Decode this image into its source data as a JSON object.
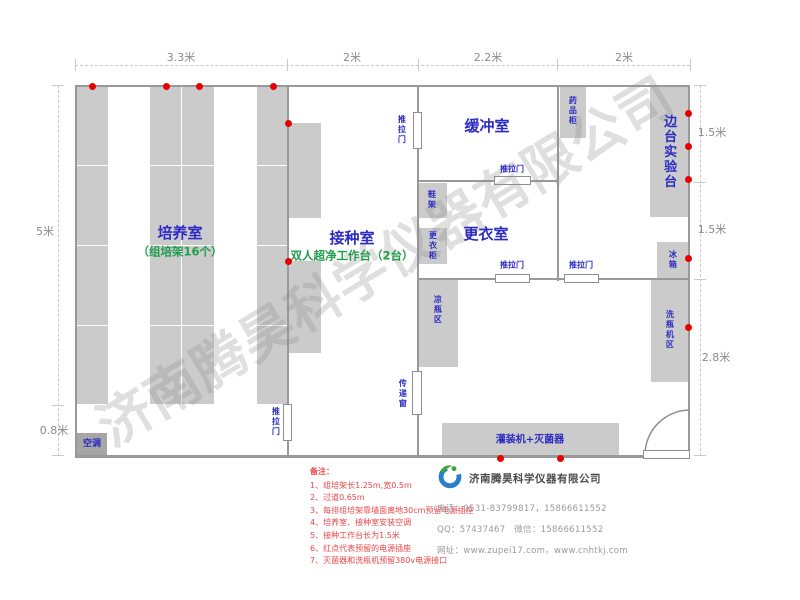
{
  "watermark": "济南腾昊科学仪器有限公司",
  "colors": {
    "blue": "#2b2bc4",
    "green": "#1f9e4d",
    "dim_grey": "#8a8a8a",
    "dot_red": "#e60000",
    "note_red": "#e8474a",
    "wall_grey": "#999999",
    "furniture_grey": "#cbcbcb"
  },
  "walls": [
    {
      "name": "outer-wall-top",
      "r": [
        75,
        85,
        615,
        2
      ]
    },
    {
      "name": "outer-wall-bottom",
      "r": [
        75,
        455,
        615,
        3
      ]
    },
    {
      "name": "outer-wall-left",
      "r": [
        75,
        85,
        2,
        373
      ]
    },
    {
      "name": "outer-wall-right",
      "r": [
        688,
        85,
        2,
        373
      ]
    },
    {
      "name": "wall-culture-inoculation-upper",
      "r": [
        287,
        85,
        2,
        320
      ]
    },
    {
      "name": "wall-culture-inoculation-lower",
      "r": [
        287,
        441,
        2,
        16
      ]
    },
    {
      "name": "wall-inoculation-buffer-upper",
      "r": [
        417,
        85,
        2,
        28
      ]
    },
    {
      "name": "wall-inoculation-buffer-lower",
      "r": [
        417,
        148,
        2,
        309
      ]
    },
    {
      "name": "wall-buffer-sidebench",
      "r": [
        557,
        85,
        2,
        196
      ]
    },
    {
      "name": "wall-buffer-changing-left",
      "r": [
        418,
        180,
        77,
        2
      ]
    },
    {
      "name": "wall-buffer-changing-right",
      "r": [
        530,
        180,
        28,
        2
      ]
    },
    {
      "name": "wall-changing-bottomroom-1",
      "r": [
        418,
        278,
        78,
        2
      ]
    },
    {
      "name": "wall-changing-bottomroom-2",
      "r": [
        529,
        278,
        36,
        2
      ]
    },
    {
      "name": "wall-changing-bottomroom-3",
      "r": [
        598,
        278,
        92,
        2
      ]
    }
  ],
  "furniture": [
    {
      "name": "culture-rack-1",
      "r": [
        77,
        86,
        31,
        318
      ]
    },
    {
      "name": "culture-rack-2",
      "r": [
        150,
        86,
        64,
        318
      ]
    },
    {
      "name": "culture-rack-3",
      "r": [
        257,
        86,
        30,
        318
      ]
    },
    {
      "name": "clean-bench-1",
      "r": [
        289,
        123,
        32,
        95
      ]
    },
    {
      "name": "clean-bench-2",
      "r": [
        289,
        261,
        32,
        92
      ]
    },
    {
      "name": "medicine-cabinet",
      "r": [
        560,
        86,
        26,
        52
      ]
    },
    {
      "name": "side-lab-bench",
      "r": [
        650,
        86,
        39,
        131
      ]
    },
    {
      "name": "fridge",
      "r": [
        657,
        242,
        32,
        36
      ]
    },
    {
      "name": "bottle-washer-area",
      "r": [
        651,
        280,
        38,
        102
      ]
    },
    {
      "name": "bottle-cooling-area",
      "r": [
        419,
        280,
        39,
        87
      ]
    },
    {
      "name": "shoe-rack",
      "r": [
        419,
        183,
        28,
        35
      ]
    },
    {
      "name": "wardrobe",
      "r": [
        419,
        228,
        28,
        36
      ]
    },
    {
      "name": "filling-sterilizer-bench",
      "r": [
        442,
        423,
        177,
        34
      ]
    },
    {
      "name": "air-conditioner",
      "r": [
        77,
        433,
        30,
        23
      ],
      "dark": true
    }
  ],
  "dividers": [
    {
      "r": [
        77,
        165,
        31,
        1
      ]
    },
    {
      "r": [
        77,
        245,
        31,
        1
      ]
    },
    {
      "r": [
        77,
        325,
        31,
        1
      ]
    },
    {
      "r": [
        150,
        165,
        64,
        1
      ]
    },
    {
      "r": [
        150,
        245,
        64,
        1
      ]
    },
    {
      "r": [
        150,
        325,
        64,
        1
      ]
    },
    {
      "r": [
        257,
        165,
        30,
        1
      ]
    },
    {
      "r": [
        257,
        245,
        30,
        1
      ]
    },
    {
      "r": [
        257,
        325,
        30,
        1
      ]
    },
    {
      "r": [
        181,
        86,
        1,
        318
      ]
    }
  ],
  "doors": [
    {
      "name": "sliding-door-culture-room",
      "r": [
        283,
        404,
        9,
        37
      ]
    },
    {
      "name": "sliding-door-inoculation-room",
      "r": [
        413,
        112,
        9,
        37
      ]
    },
    {
      "name": "transfer-window",
      "r": [
        412,
        371,
        10,
        44
      ]
    },
    {
      "name": "sliding-door-buffer-changing",
      "r": [
        494,
        176,
        37,
        9
      ]
    },
    {
      "name": "sliding-door-changing-bottom",
      "r": [
        495,
        274,
        35,
        9
      ]
    },
    {
      "name": "sliding-door-sidebench-bottom",
      "r": [
        564,
        274,
        35,
        9
      ]
    },
    {
      "name": "entrance-door-leaf",
      "r": [
        643,
        450,
        47,
        9
      ]
    }
  ],
  "entrance_arc": {
    "cx": 690,
    "cy": 455,
    "r": 45
  },
  "dots": [
    {
      "x": 92,
      "y": 86
    },
    {
      "x": 166,
      "y": 86
    },
    {
      "x": 199,
      "y": 86
    },
    {
      "x": 273,
      "y": 86
    },
    {
      "x": 288,
      "y": 123
    },
    {
      "x": 288,
      "y": 261
    },
    {
      "x": 500,
      "y": 458
    },
    {
      "x": 560,
      "y": 458
    },
    {
      "x": 688,
      "y": 113
    },
    {
      "x": 688,
      "y": 146
    },
    {
      "x": 688,
      "y": 179
    },
    {
      "x": 688,
      "y": 258
    },
    {
      "x": 688,
      "y": 327
    }
  ],
  "labels": [
    {
      "name": "culture-room-label",
      "t": "培养室",
      "x": 180,
      "y": 233,
      "s": 15,
      "b": 1,
      "c": "blue"
    },
    {
      "name": "culture-room-sublabel",
      "t": "（组培架16个）",
      "x": 180,
      "y": 252,
      "s": 11.5,
      "b": 1,
      "c": "green"
    },
    {
      "name": "inoculation-room-label",
      "t": "接种室",
      "x": 352,
      "y": 238,
      "s": 15,
      "b": 1,
      "c": "blue"
    },
    {
      "name": "inoculation-room-sublabel",
      "t": "双人超净工作台（2台）",
      "x": 352,
      "y": 256,
      "s": 11.5,
      "b": 1,
      "c": "green"
    },
    {
      "name": "buffer-room-label",
      "t": "缓冲室",
      "x": 487,
      "y": 126,
      "s": 15,
      "b": 1,
      "c": "blue"
    },
    {
      "name": "changing-room-label",
      "t": "更衣室",
      "x": 486,
      "y": 234,
      "s": 15,
      "b": 1,
      "c": "blue"
    },
    {
      "name": "side-lab-bench-label",
      "t": "边台实验台",
      "x": 668,
      "y": 152,
      "s": 13,
      "b": 1,
      "c": "blue",
      "v": 1
    },
    {
      "name": "medicine-cabinet-label",
      "t": "药品柜",
      "x": 572,
      "y": 111,
      "s": 8,
      "b": 1,
      "c": "blue",
      "v": 1
    },
    {
      "name": "shoe-rack-label",
      "t": "鞋架",
      "x": 431,
      "y": 200,
      "s": 8,
      "b": 1,
      "c": "blue",
      "v": 1
    },
    {
      "name": "wardrobe-label",
      "t": "更衣柜",
      "x": 432,
      "y": 246,
      "s": 8,
      "b": 1,
      "c": "blue",
      "v": 1
    },
    {
      "name": "bottle-cooling-label",
      "t": "凉瓶区",
      "x": 437,
      "y": 310,
      "s": 8,
      "b": 1,
      "c": "blue",
      "v": 1
    },
    {
      "name": "fridge-label",
      "t": "冰箱",
      "x": 672,
      "y": 260,
      "s": 8,
      "b": 1,
      "c": "blue",
      "v": 1
    },
    {
      "name": "bottle-washer-label",
      "t": "洗瓶机区",
      "x": 669,
      "y": 330,
      "s": 8,
      "b": 1,
      "c": "blue",
      "v": 1
    },
    {
      "name": "transfer-window-label",
      "t": "传递窗",
      "x": 402,
      "y": 394,
      "s": 8,
      "b": 1,
      "c": "blue",
      "v": 1
    },
    {
      "name": "sliding-door-label-1",
      "t": "推拉门",
      "x": 401,
      "y": 130,
      "s": 8,
      "b": 1,
      "c": "blue",
      "v": 1
    },
    {
      "name": "sliding-door-label-2",
      "t": "推拉门",
      "x": 275,
      "y": 422,
      "s": 8,
      "b": 1,
      "c": "blue",
      "v": 1
    },
    {
      "name": "sliding-door-label-3",
      "t": "推拉门",
      "x": 512,
      "y": 170,
      "s": 8,
      "b": 1,
      "c": "blue"
    },
    {
      "name": "sliding-door-label-4",
      "t": "推拉门",
      "x": 512,
      "y": 266,
      "s": 8,
      "b": 1,
      "c": "blue"
    },
    {
      "name": "sliding-door-label-5",
      "t": "推拉门",
      "x": 581,
      "y": 266,
      "s": 8,
      "b": 1,
      "c": "blue"
    },
    {
      "name": "filling-sterilizer-label",
      "t": "灌装机+灭菌器",
      "x": 530,
      "y": 440,
      "s": 10,
      "b": 1,
      "c": "blue"
    },
    {
      "name": "air-conditioner-label",
      "t": "空调",
      "x": 92,
      "y": 445,
      "s": 9,
      "b": 1,
      "c": "blue"
    },
    {
      "name": "dim-top-1",
      "t": "3.3米",
      "x": 181,
      "y": 58,
      "s": 11,
      "c": "grey"
    },
    {
      "name": "dim-top-2",
      "t": "2米",
      "x": 352,
      "y": 58,
      "s": 11,
      "c": "grey"
    },
    {
      "name": "dim-top-3",
      "t": "2.2米",
      "x": 488,
      "y": 58,
      "s": 11,
      "c": "grey"
    },
    {
      "name": "dim-top-4",
      "t": "2米",
      "x": 624,
      "y": 58,
      "s": 11,
      "c": "grey"
    },
    {
      "name": "dim-left-1",
      "t": "5米",
      "x": 45,
      "y": 232,
      "s": 11,
      "c": "grey"
    },
    {
      "name": "dim-left-2",
      "t": "0.8米",
      "x": 54,
      "y": 431,
      "s": 11,
      "c": "grey"
    },
    {
      "name": "dim-right-1",
      "t": "1.5米",
      "x": 712,
      "y": 133,
      "s": 11,
      "c": "grey"
    },
    {
      "name": "dim-right-2",
      "t": "1.5米",
      "x": 712,
      "y": 230,
      "s": 11,
      "c": "grey"
    },
    {
      "name": "dim-right-3",
      "t": "2.8米",
      "x": 716,
      "y": 358,
      "s": 11,
      "c": "grey"
    }
  ],
  "dim_lines": [
    {
      "name": "dim-line-top",
      "kind": "h",
      "x": 75,
      "y": 65,
      "len": 615
    },
    {
      "name": "dim-line-left",
      "kind": "v",
      "x": 58,
      "y": 85,
      "len": 371
    },
    {
      "name": "dim-line-right",
      "kind": "v",
      "x": 700,
      "y": 85,
      "len": 371
    }
  ],
  "ticks": [
    {
      "r": [
        75,
        59,
        1,
        12
      ]
    },
    {
      "r": [
        287,
        59,
        1,
        12
      ]
    },
    {
      "r": [
        418,
        59,
        1,
        12
      ]
    },
    {
      "r": [
        557,
        59,
        1,
        12
      ]
    },
    {
      "r": [
        690,
        59,
        1,
        12
      ]
    },
    {
      "r": [
        52,
        85,
        12,
        1
      ]
    },
    {
      "r": [
        52,
        405,
        12,
        1
      ]
    },
    {
      "r": [
        52,
        455,
        12,
        1
      ]
    },
    {
      "r": [
        694,
        85,
        12,
        1
      ]
    },
    {
      "r": [
        694,
        182,
        12,
        1
      ]
    },
    {
      "r": [
        694,
        279,
        12,
        1
      ]
    },
    {
      "r": [
        694,
        455,
        12,
        1
      ]
    }
  ],
  "notes": {
    "title": "备注：",
    "items": [
      "1、组培架长1.25m,宽0.5m",
      "2、过道0.65m",
      "3、每排组培架靠墙面离地30cm预留电源插座",
      "4、培养室、接种室安装空调",
      "5、接种工作台长为1.5米",
      "6、红点代表预留的电源插座",
      "7、灭菌器和洗瓶机预留380v电源接口"
    ]
  },
  "company": {
    "name": "济南腾昊科学仪器有限公司",
    "phone_line": "电话：0531-83799817，15866611552",
    "qq_line": "QQ：57437467　微信：15866611552",
    "web_line": "网址：www.zupei17.com，www.cnhtkj.com"
  }
}
